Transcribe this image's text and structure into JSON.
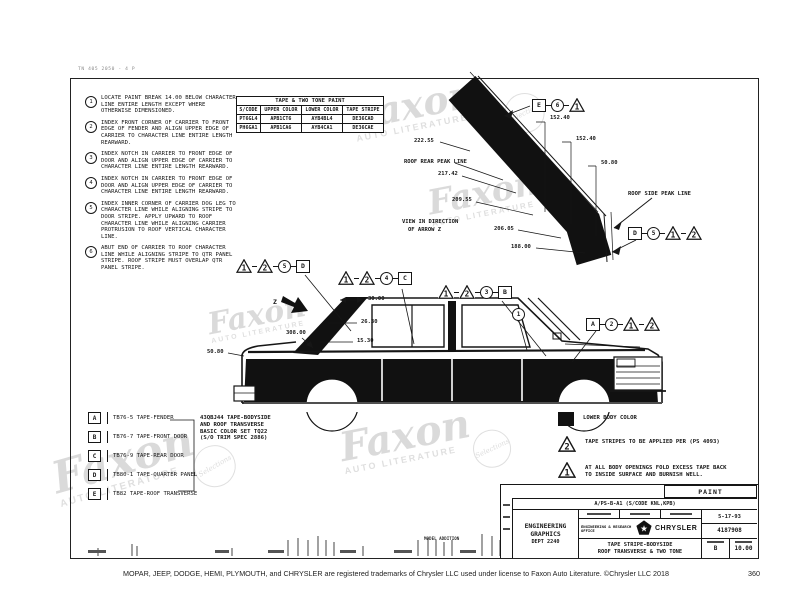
{
  "meta": {
    "corner_note": "TN 405 2050 - 4 P",
    "footer": "MOPAR, JEEP, DODGE, HEMI, PLYMOUTH, and CHRYSLER are registered trademarks of Chrysler LLC used under license to Faxon Auto Literature. ©Chrysler LLC 2018",
    "page_number": "360"
  },
  "watermark": {
    "word": "Faxon",
    "subtitle": "AUTO LITERATURE",
    "badge_text": "Selections"
  },
  "colors": {
    "ink": "#161616",
    "paper": "#ffffff",
    "lower_body_fill": "#111111",
    "watermark_gray": "#c0c0c0"
  },
  "notes": {
    "items": [
      {
        "num": "1",
        "text": "LOCATE PAINT BREAK 14.00 BELOW CHARACTER LINE ENTIRE LENGTH EXCEPT WHERE OTHERWISE DIMENSIONED."
      },
      {
        "num": "2",
        "text": "INDEX FRONT CORNER OF CARRIER TO FRONT EDGE OF FENDER AND ALIGN UPPER EDGE OF CARRIER TO CHARACTER LINE ENTIRE LENGTH REARWARD."
      },
      {
        "num": "3",
        "text": "INDEX NOTCH IN CARRIER TO FRONT EDGE OF DOOR AND ALIGN UPPER EDGE OF CARRIER TO CHARACTER LINE ENTIRE LENGTH REARWARD."
      },
      {
        "num": "4",
        "text": "INDEX NOTCH IN CARRIER TO FRONT EDGE OF DOOR AND ALIGN UPPER EDGE OF CARRIER TO CHARACTER LINE ENTIRE LENGTH REARWARD."
      },
      {
        "num": "5",
        "text": "INDEX INNER CORNER OF CARRIER DOG LEG TO CHARACTER LINE WHILE ALIGNING STRIPE TO DOOR STRIPE. APPLY UPWARD TO ROOF CHARACTER LINE WHILE ALIGNING CARRIER PROTRUSION TO ROOF VERTICAL CHARACTER LINE."
      },
      {
        "num": "6",
        "text": "ABUT END OF CARRIER TO ROOF CHARACTER LINE WHILE ALIGNING STRIPE TO QTR PANEL STRIPE. ROOF STRIPE MUST OVERLAP QTR PANEL STRIPE."
      }
    ]
  },
  "paint_table": {
    "title": "TAPE & TWO TONE PAINT",
    "headers": [
      "S/CODE",
      "UPPER COLOR",
      "LOWER COLOR",
      "TAPE STRIPE"
    ],
    "rows": [
      [
        "PT6GL4",
        "APB1CT6",
        "AYB4BL4",
        "DE36CAD"
      ],
      [
        "PH6GA1",
        "APB1CA6",
        "AYB4CA1",
        "DE36CAE"
      ]
    ]
  },
  "roof_detail": {
    "rear_peak_label": "ROOF REAR PEAK LINE",
    "side_peak_label": "ROOF SIDE PEAK LINE",
    "view_label_1": "VIEW IN DIRECTION",
    "view_label_2": "OF ARROW Z",
    "dims": {
      "top1": "152.40",
      "top2": "152.40",
      "top3": "50.80",
      "left1": "222.55",
      "left2": "217.42",
      "left3": "209.55",
      "left4": "206.05",
      "left5": "188.00"
    },
    "callouts_top": [
      {
        "s": "sq",
        "l": "E"
      },
      {
        "s": "ci",
        "l": "6"
      },
      {
        "s": "tr",
        "l": "1"
      }
    ],
    "callouts_bottom": [
      {
        "s": "sq",
        "l": "D"
      },
      {
        "s": "ci",
        "l": "5"
      },
      {
        "s": "tr",
        "l": "1"
      },
      {
        "s": "tr",
        "l": "2"
      }
    ]
  },
  "car_view": {
    "arrow_label": "Z",
    "dims": {
      "w1": "30.00",
      "w2": "26.30",
      "w3": "15.30",
      "deck": "308.00",
      "rear": "50.80"
    },
    "groups": {
      "quarter": [
        {
          "s": "tr",
          "l": "1"
        },
        {
          "s": "tr",
          "l": "2"
        },
        {
          "s": "ci",
          "l": "5"
        },
        {
          "s": "sq",
          "l": "D"
        }
      ],
      "rear_door": [
        {
          "s": "tr",
          "l": "1"
        },
        {
          "s": "tr",
          "l": "2"
        },
        {
          "s": "ci",
          "l": "4"
        },
        {
          "s": "sq",
          "l": "C"
        }
      ],
      "front_door": [
        {
          "s": "tr",
          "l": "1"
        },
        {
          "s": "tr",
          "l": "2"
        },
        {
          "s": "ci",
          "l": "3"
        },
        {
          "s": "sq",
          "l": "B"
        }
      ],
      "fender": [
        {
          "s": "sq",
          "l": "A"
        },
        {
          "s": "ci",
          "l": "2"
        },
        {
          "s": "tr",
          "l": "1"
        },
        {
          "s": "tr",
          "l": "2"
        }
      ],
      "paint_break": [
        {
          "s": "ci",
          "l": "1"
        }
      ]
    }
  },
  "parts_legend": {
    "rows": [
      {
        "code": "A",
        "desc": "TB76-5 TAPE-FENDER"
      },
      {
        "code": "B",
        "desc": "TB76-7 TAPE-FRONT DOOR"
      },
      {
        "code": "C",
        "desc": "TB76-9 TAPE-REAR DOOR"
      },
      {
        "code": "D",
        "desc": "TB80-1 TAPE-QUARTER PANEL"
      },
      {
        "code": "E",
        "desc": "TB82 TAPE-ROOF TRANSVERSE"
      }
    ],
    "note_lines": [
      "43QBJ44 TAPE-BODYSIDE",
      "AND ROOF TRANSVERSE",
      "BASIC COLOR SET TQ22",
      "(S/O TRIM SPEC 2886)"
    ]
  },
  "symbols_legend": {
    "lower_body": "LOWER BODY COLOR",
    "tri2_label": "2",
    "tape_note": "TAPE STRIPES TO BE APPLIED PER (PS 4093)",
    "tri1_label": "1",
    "fold_note_1": "AT ALL BODY OPENINGS FOLD EXCESS TAPE BACK",
    "fold_note_2": "TO INSIDE SURFACE AND BURNISH WELL."
  },
  "title_block": {
    "paint_label": "PAINT",
    "code_line": "A/PS-B-A1 (S/CODE KNL,KPB)",
    "dept_line1": "ENGINEERING",
    "dept_line2": "GRAPHICS",
    "dept_line3": "DEPT 2240",
    "office": "ENGINEERING & RESEARCH OFFICE",
    "brand": "CHRYSLER",
    "date": "5-17-93",
    "number": "4187908",
    "title_line1": "TAPE STRIPE-BODYSIDE",
    "title_line2": "ROOF TRANSVERSE & TWO TONE",
    "sheet": "B",
    "scale": "10.00",
    "strip_note": "MODEL ADDITION"
  }
}
